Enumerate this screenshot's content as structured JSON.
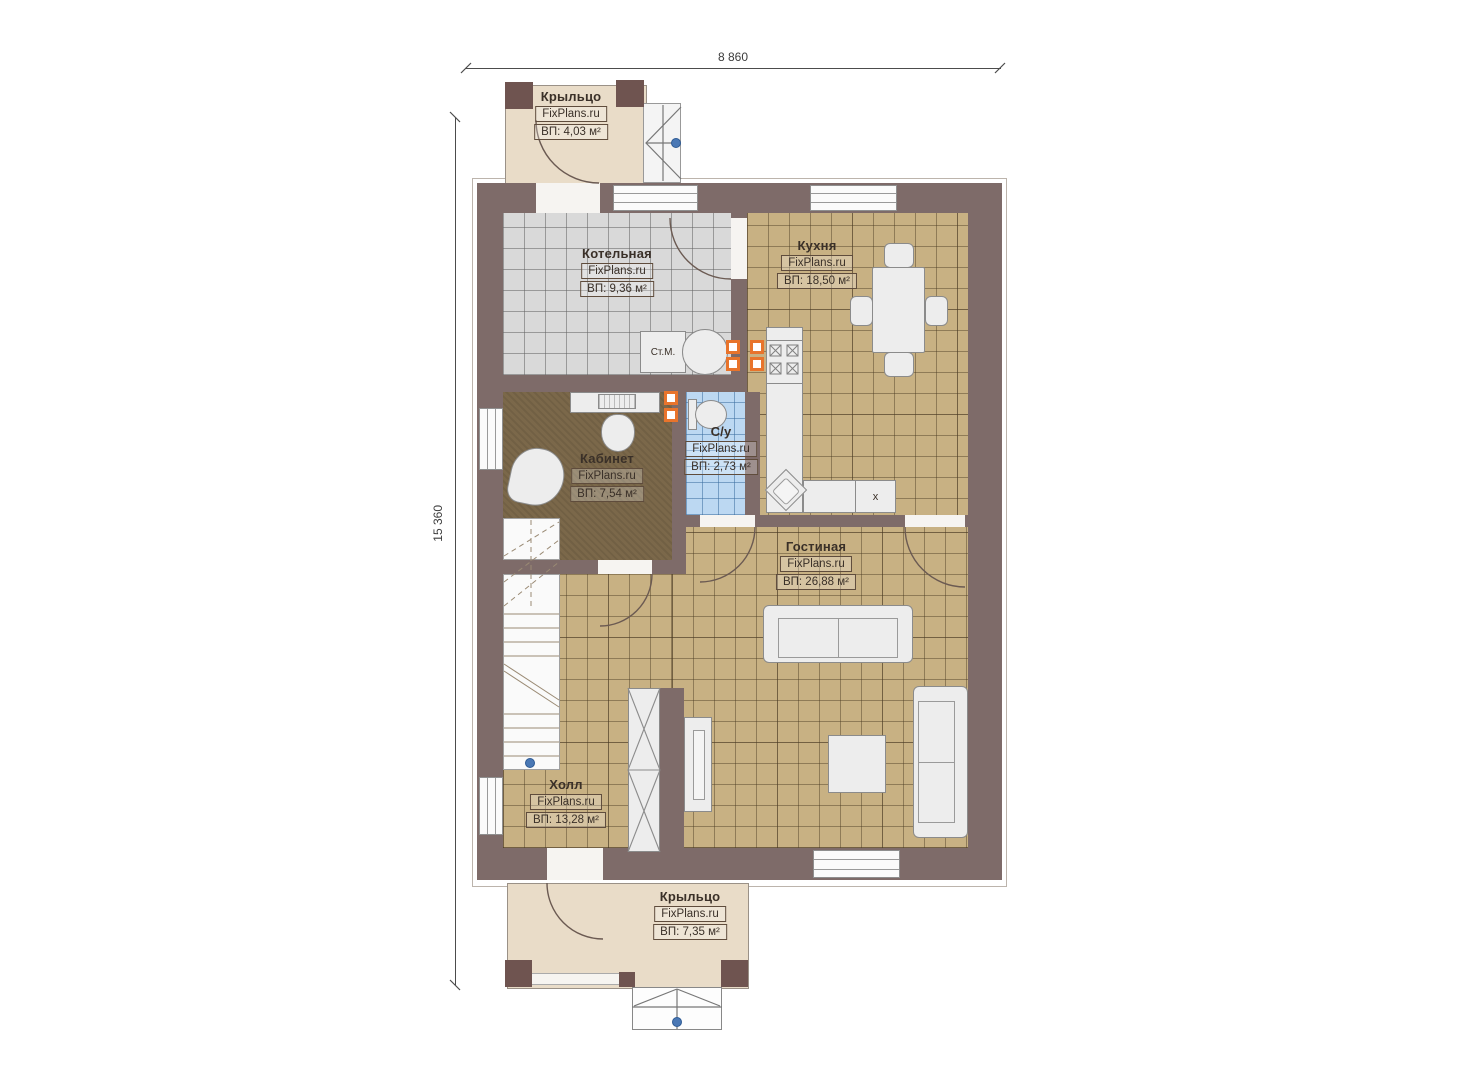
{
  "title": "План первого этажа",
  "dimensions": {
    "width": "8 860",
    "height": "15 360"
  },
  "rooms": [
    {
      "id": "porch-top",
      "name": "Крыльцо",
      "watermark": "FixPlans.ru",
      "area": "ВП: 4,03 м²"
    },
    {
      "id": "boiler-room",
      "name": "Котельная",
      "watermark": "FixPlans.ru",
      "area": "ВП: 9,36 м²"
    },
    {
      "id": "kitchen",
      "name": "Кухня",
      "watermark": "FixPlans.ru",
      "area": "ВП: 18,50 м²"
    },
    {
      "id": "study",
      "name": "Кабинет",
      "watermark": "FixPlans.ru",
      "area": "ВП: 7,54 м²"
    },
    {
      "id": "bathroom",
      "name": "С/у",
      "watermark": "FixPlans.ru",
      "area": "ВП: 2,73 м²"
    },
    {
      "id": "living-room",
      "name": "Гостиная",
      "watermark": "FixPlans.ru",
      "area": "ВП: 26,88 м²"
    },
    {
      "id": "hall",
      "name": "Холл",
      "watermark": "FixPlans.ru",
      "area": "ВП: 13,28 м²"
    },
    {
      "id": "porch-bottom",
      "name": "Крыльцо",
      "watermark": "FixPlans.ru",
      "area": "ВП: 7,35 м²"
    }
  ],
  "annotations": {
    "washing_machine": "Ст.М.",
    "counter_appliance": "x"
  },
  "colors": {
    "wall": "#7e6b69",
    "wall_dark": "#6a4f4b",
    "floor_tile_tan": "#c8b183",
    "floor_tile_gray": "#d9d9d9",
    "floor_carpet_brown": "#7b684a",
    "floor_tile_blue": "#bcd8f2",
    "porch": "#e9dcc8",
    "pillar": "#6f5450",
    "furniture": "#ededed",
    "socket_orange": "#e8742c",
    "marker_blue": "#4a78b5",
    "line": "#6b5a52",
    "text": "#3a3028"
  }
}
